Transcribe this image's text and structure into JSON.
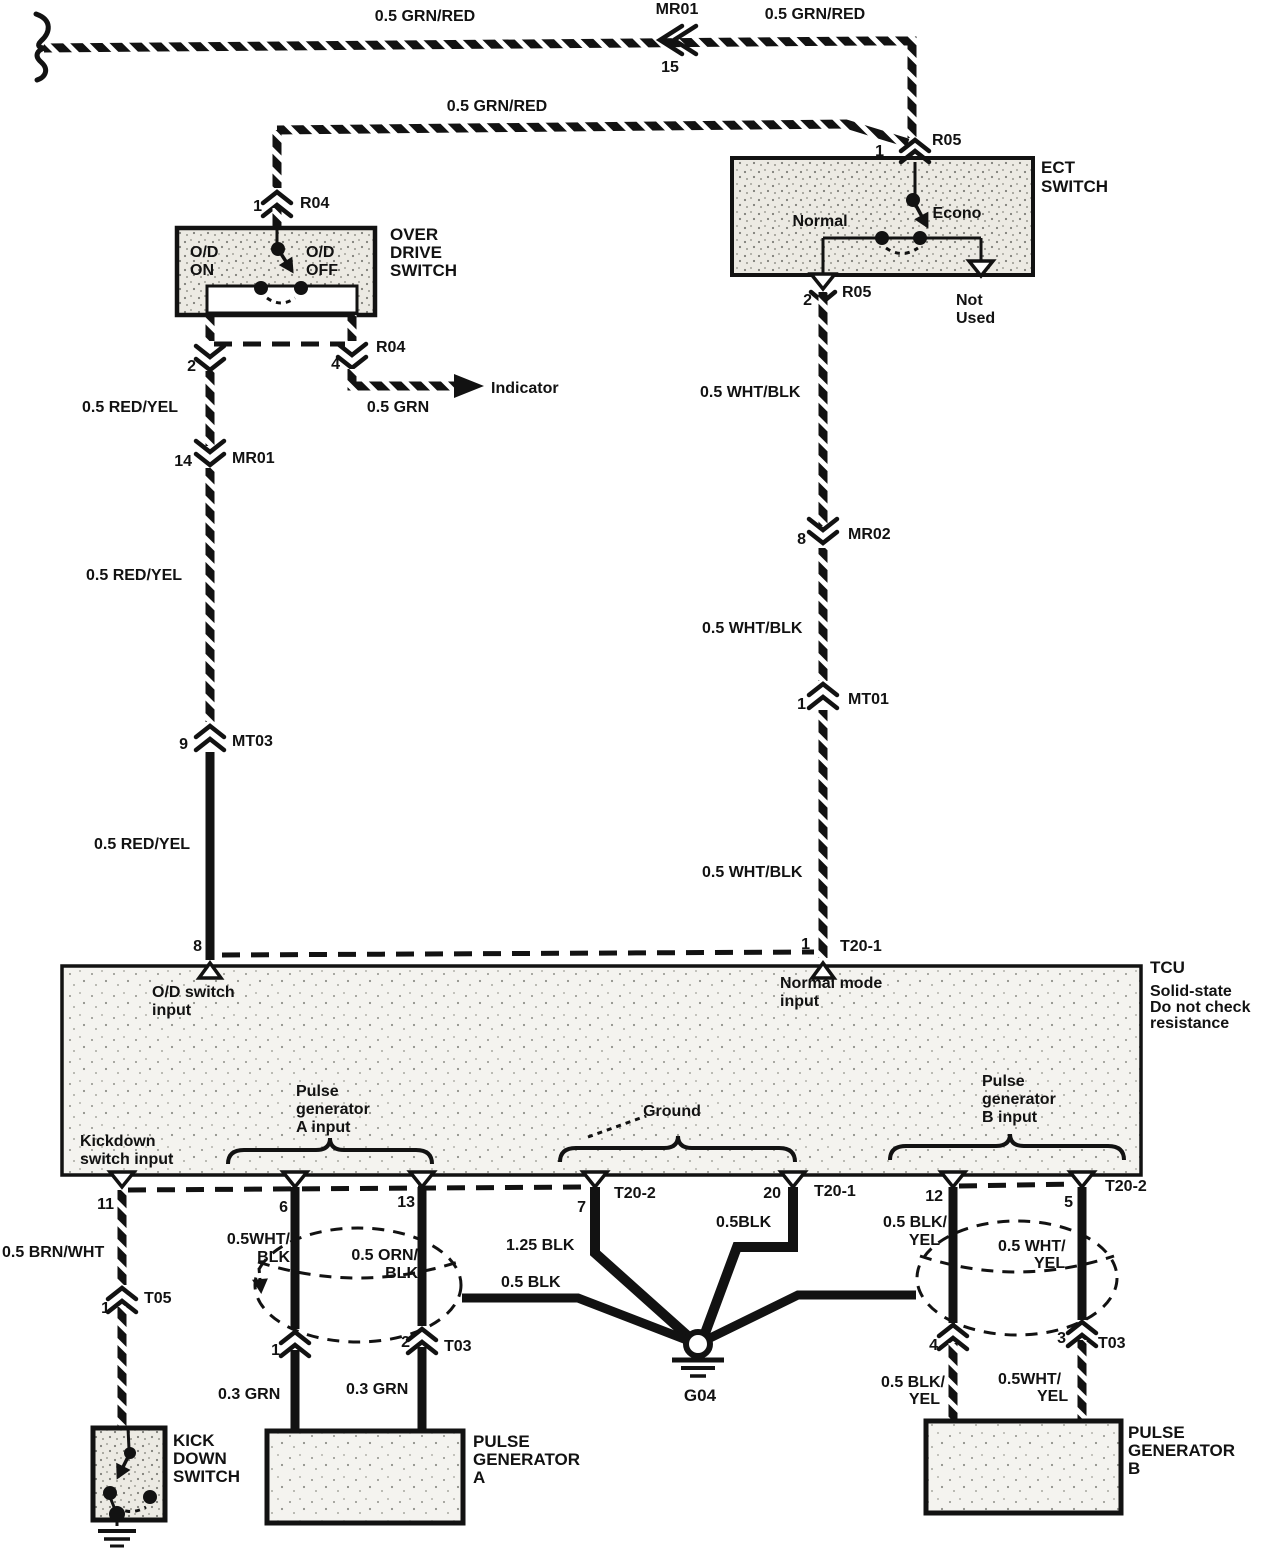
{
  "colors": {
    "ink": "#121212",
    "paper": "#ffffff"
  },
  "top": {
    "wire_left_label": "0.5 GRN/RED",
    "splice_name": "MR01",
    "splice_pin": "15",
    "wire_right_label": "0.5 GRN/RED",
    "branch_wire_label": "0.5 GRN/RED"
  },
  "overdrive_switch": {
    "pin1": "1",
    "pin1_connector": "R04",
    "title_l1": "OVER",
    "title_l2": "DRIVE",
    "title_l3": "SWITCH",
    "pos_on_l1": "O/D",
    "pos_on_l2": "ON",
    "pos_off_l1": "O/D",
    "pos_off_l2": "OFF",
    "pin2": "2",
    "pin4": "4",
    "pin4_connector": "R04",
    "indicator_label": "Indicator",
    "indicator_wire": "0.5 GRN"
  },
  "left_run": {
    "wire1": "0.5 RED/YEL",
    "mr01_pin": "14",
    "mr01": "MR01",
    "wire2": "0.5 RED/YEL",
    "mt03_pin": "9",
    "mt03": "MT03",
    "wire3": "0.5 RED/YEL",
    "tcu_pin": "8"
  },
  "ect_switch": {
    "pin1": "1",
    "pin1_connector": "R05",
    "title_l1": "ECT",
    "title_l2": "SWITCH",
    "normal": "Normal",
    "econo": "Econo",
    "pin2": "2",
    "pin2_connector": "R05",
    "not_used_l1": "Not",
    "not_used_l2": "Used"
  },
  "right_run": {
    "wire1": "0.5 WHT/BLK",
    "mr02_pin": "8",
    "mr02": "MR02",
    "wire2": "0.5 WHT/BLK",
    "mt01_pin": "1",
    "mt01": "MT01",
    "wire3": "0.5 WHT/BLK",
    "tcu_pin": "1",
    "tcu_connector": "T20-1"
  },
  "tcu": {
    "name": "TCU",
    "note_l1": "Solid-state",
    "note_l2": "Do not check",
    "note_l3": "resistance",
    "od_input_l1": "O/D switch",
    "od_input_l2": "input",
    "normal_input_l1": "Normal mode",
    "normal_input_l2": "input",
    "kickdown_l1": "Kickdown",
    "kickdown_l2": "switch input",
    "pga_l1": "Pulse",
    "pga_l2": "generator",
    "pga_l3": "A input",
    "ground_label": "Ground",
    "pgb_l1": "Pulse",
    "pgb_l2": "generator",
    "pgb_l3": "B input",
    "pin11": "11",
    "pin6": "6",
    "pin13": "13",
    "pin7": "7",
    "pin7_connector": "T20-2",
    "pin20": "20",
    "pin20_connector": "T20-1",
    "pin12": "12",
    "pin5": "5",
    "pin5_connector": "T20-2"
  },
  "kickdown": {
    "wire": "0.5 BRN/WHT",
    "t05_pin": "1",
    "t05": "T05",
    "title_l1": "KICK",
    "title_l2": "DOWN",
    "title_l3": "SWITCH"
  },
  "pulse_gen_a": {
    "wire6_l1": "0.5WHT/",
    "wire6_l2": "BLK",
    "wire13_l1": "0.5 ORN/",
    "wire13_l2": "BLK",
    "pin1": "1",
    "pin2": "2",
    "connector": "T03",
    "wire1": "0.3 GRN",
    "wire2": "0.3 GRN",
    "title_l1": "PULSE",
    "title_l2": "GENERATOR",
    "title_l3": "A"
  },
  "ground": {
    "wire7": "1.25 BLK",
    "drain": "0.5 BLK",
    "wire20": "0.5BLK",
    "name": "G04"
  },
  "pulse_gen_b": {
    "wire12_l1": "0.5 BLK/",
    "wire12_l2": "YEL",
    "wire5_l1": "0.5 WHT/",
    "wire5_l2": "YEL",
    "pin4": "4",
    "pin3": "3",
    "connector": "T03",
    "wire4_l1": "0.5 BLK/",
    "wire4_l2": "YEL",
    "wire3_l1": "0.5WHT/",
    "wire3_l2": "YEL",
    "title_l1": "PULSE",
    "title_l2": "GENERATOR",
    "title_l3": "B"
  }
}
